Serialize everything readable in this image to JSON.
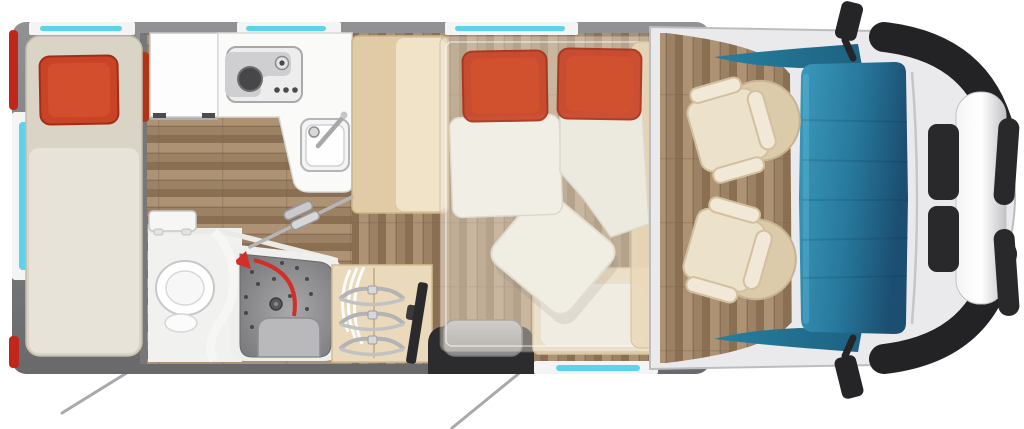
{
  "image": {
    "kind": "motorhome-floorplan-top-view",
    "width_px": 1024,
    "height_px": 429
  },
  "icons": {
    "freezer_icon": "snowflake-asterisk",
    "swivel_arrow_icon": "curved-arrow-left"
  },
  "counts": {
    "top_windows": 3,
    "left_windows": 1,
    "bottom_windows": 1,
    "wardrobe_hangers": 3,
    "cab_seats": 2,
    "bed_pillows": 3,
    "shower_drain_dots": 16,
    "leader_lines": 2
  },
  "colors": {
    "page_bg": "#ffffff",
    "wall_gray": "#7b7b7d",
    "wall_gray_light": "#9a9a9c",
    "window_frame": "#f4f4f4",
    "window_glass": "#5cd2ec",
    "accent_red": "#c1261b",
    "pillow_red": "#c94427",
    "pillow_red_deep": "#b23418",
    "mattress_beige": "#d9d4c6",
    "mattress_light": "#e7e3d8",
    "furniture_beige": "#ead9ba",
    "furniture_beige_dark": "#e0cba6",
    "wood_base": "#9c8265",
    "wood_dark": "#8a6f53",
    "wood_light": "#ad9274",
    "counter_white": "#fafaf8",
    "bathroom_white": "#f1f1ef",
    "shower_gray": "#8f8f91",
    "shower_gray_dark": "#757577",
    "arrow_red": "#d22f28",
    "step_gray": "#aaaaac",
    "door_black": "#2c2c2e",
    "tv_black": "#2a2a2c",
    "cab_body": "#eaeaec",
    "cab_trim_black": "#232325",
    "windshield_light": "#3b9abc",
    "windshield_mid": "#27789c",
    "windshield_dark": "#1b4e71",
    "dashboard_teal": "#27809f",
    "dashboard_teal_dark": "#1d6182",
    "seat_cushion": "#ece1cb",
    "seat_trim": "#f1e8d7",
    "seat_base": "#dbcbab",
    "seat_border": "#d0bd9a",
    "table_white": "#f2f1ea",
    "overlay_bed": "#efe8da",
    "snowflake_dark": "#2a6cd0",
    "snowflake_light": "#3fbde8",
    "leader_line": "#a9a9ab"
  }
}
